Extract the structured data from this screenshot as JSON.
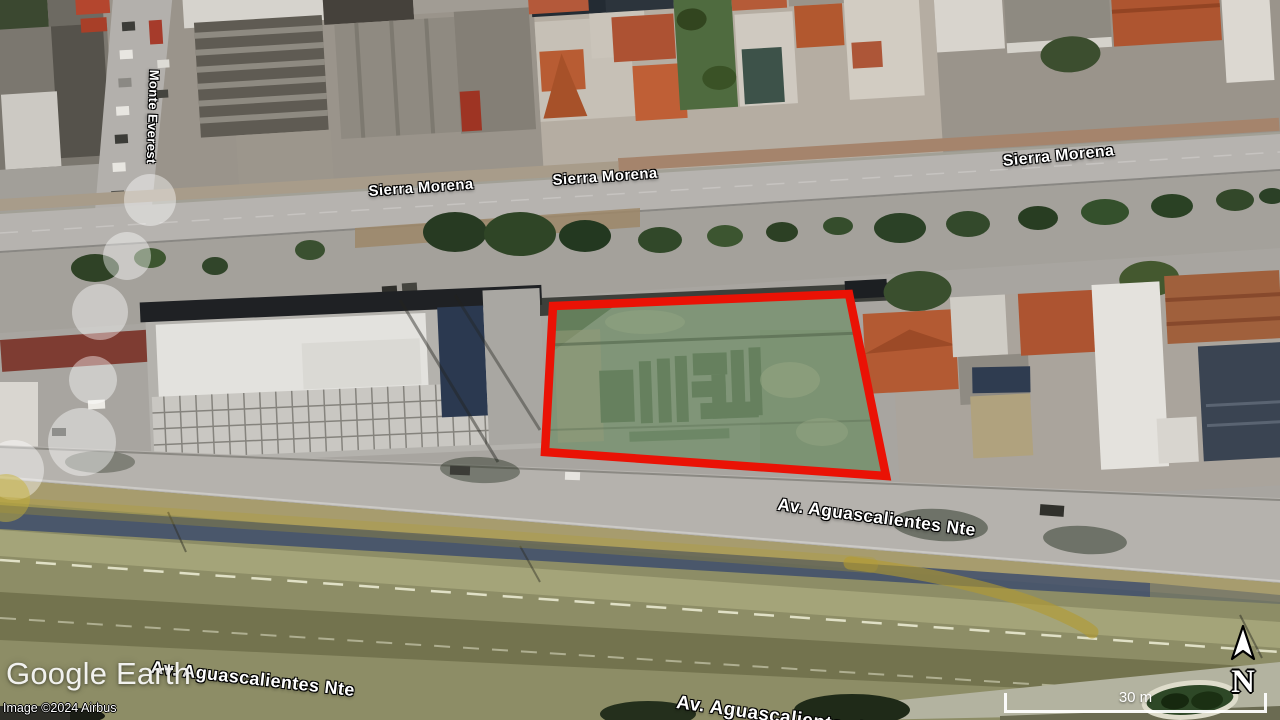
{
  "app": {
    "name": "Google Earth"
  },
  "map": {
    "street_labels": [
      {
        "id": "sierra-morena-left",
        "text": "Sierra Morena"
      },
      {
        "id": "sierra-morena-center",
        "text": "Sierra Morena"
      },
      {
        "id": "sierra-morena-right",
        "text": "Sierra Morena"
      },
      {
        "id": "monte-everest",
        "text": "Monte Everest"
      },
      {
        "id": "av-aguascalientes-mid",
        "text": "Av. Aguascalientes Nte"
      },
      {
        "id": "av-aguascalientes-bottom-left",
        "text": "Av. Aguascalientes Nte"
      },
      {
        "id": "av-aguascalientes-bottom-center",
        "text": "Av. Aguascalientes Nte"
      }
    ],
    "overlay": {
      "parcel_outline_color": "#ea1205",
      "route_color": "#b49b2e",
      "track_point_color": "#ffffff"
    }
  },
  "attribution": {
    "logo": "Google Earth",
    "imagery_credit": "Image ©2024 Airbus"
  },
  "hud": {
    "scale_label": "30 m",
    "north_label": "N"
  }
}
